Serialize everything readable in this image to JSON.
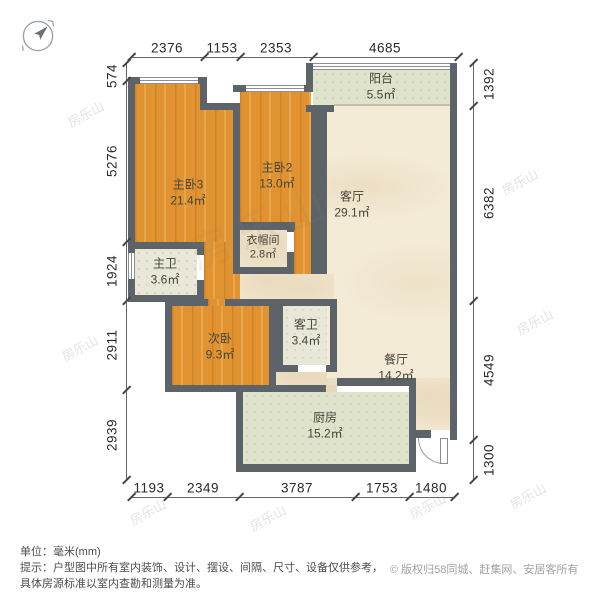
{
  "rooms": {
    "bedroom3": {
      "name": "主卧3",
      "area": "21.4㎡"
    },
    "bedroom2": {
      "name": "主卧2",
      "area": "13.0㎡"
    },
    "secondary_bedroom": {
      "name": "次卧",
      "area": "9.3㎡"
    },
    "living_room": {
      "name": "客厅",
      "area": "29.1㎡"
    },
    "dining_room": {
      "name": "餐厅",
      "area": "14.2㎡"
    },
    "kitchen": {
      "name": "厨房",
      "area": "15.2㎡"
    },
    "balcony": {
      "name": "阳台",
      "area": "5.5㎡"
    },
    "cloakroom": {
      "name": "衣帽间",
      "area": "2.8㎡"
    },
    "master_bathroom": {
      "name": "主卫",
      "area": "3.6㎡"
    },
    "guest_bathroom": {
      "name": "客卫",
      "area": "3.4㎡"
    }
  },
  "dimensions_mm": {
    "top": [
      "2376",
      "1153",
      "2353",
      "4685"
    ],
    "bottom": [
      "1193",
      "2349",
      "3787",
      "1753",
      "1480"
    ],
    "left": [
      "574",
      "5276",
      "1924",
      "2911",
      "2939"
    ],
    "right": [
      "1392",
      "6382",
      "4549",
      "1300"
    ]
  },
  "watermark_text": "房乐山",
  "footer": {
    "unit_label": "单位：毫米(mm)",
    "tip_line1": "提示：户型图中所有室内装饰、设计、摆设、间隔、尺寸、设备仅供参考，",
    "tip_line2": "具体房源标准以室内查勘和测量为准。",
    "copyright": "© 版权归58同城、赶集网、安居客所有"
  },
  "colors": {
    "wall": "#5d6469",
    "wood_floor": "#e09330",
    "beige_floor": "#f4ebd7",
    "tile_floor": "#e0e3cb",
    "bath_floor": "#e9e7d7"
  }
}
